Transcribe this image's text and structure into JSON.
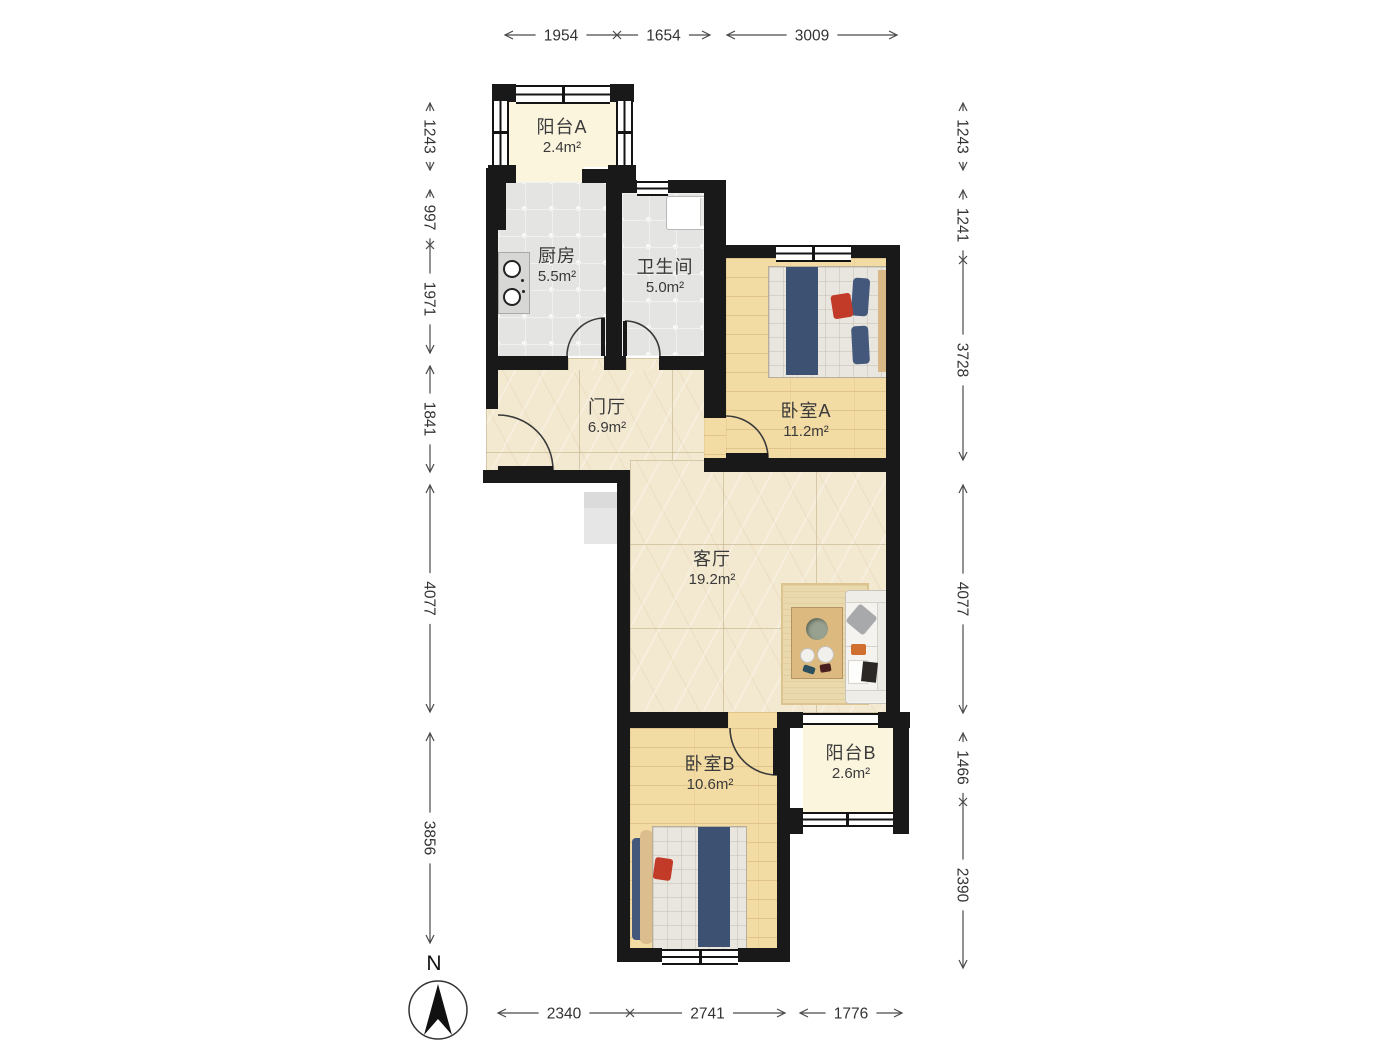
{
  "rooms": {
    "balcony_a": {
      "name": "阳台A",
      "area": "2.4m²"
    },
    "kitchen": {
      "name": "厨房",
      "area": "5.5m²"
    },
    "bathroom": {
      "name": "卫生间",
      "area": "5.0m²"
    },
    "foyer": {
      "name": "门厅",
      "area": "6.9m²"
    },
    "bedroom_a": {
      "name": "卧室A",
      "area": "11.2m²"
    },
    "living_room": {
      "name": "客厅",
      "area": "19.2m²"
    },
    "bedroom_b": {
      "name": "卧室B",
      "area": "10.6m²"
    },
    "balcony_b": {
      "name": "阳台B",
      "area": "2.6m²"
    }
  },
  "compass": {
    "label": "N"
  },
  "dimensions": {
    "top": {
      "y": 35,
      "segments": [
        {
          "value": "1954",
          "from": 505,
          "to": 617,
          "end_marker": "x"
        },
        {
          "value": "1654",
          "from": 617,
          "to": 710,
          "start_marker": "none"
        },
        {
          "value": "3009",
          "from": 727,
          "to": 897
        }
      ]
    },
    "bottom": {
      "y": 1013,
      "segments": [
        {
          "value": "2340",
          "from": 498,
          "to": 630,
          "end_marker": "x"
        },
        {
          "value": "2741",
          "from": 630,
          "to": 785,
          "start_marker": "none"
        },
        {
          "value": "1776",
          "from": 800,
          "to": 902
        }
      ]
    },
    "left": {
      "x": 430,
      "segments": [
        {
          "value": "1243",
          "from": 103,
          "to": 170
        },
        {
          "value": "997",
          "from": 190,
          "to": 245,
          "end_marker": "x"
        },
        {
          "value": "1971",
          "from": 245,
          "to": 353,
          "start_marker": "none"
        },
        {
          "value": "1841",
          "from": 366,
          "to": 472
        },
        {
          "value": "4077",
          "from": 485,
          "to": 712
        },
        {
          "value": "3856",
          "from": 733,
          "to": 943
        }
      ]
    },
    "right": {
      "x": 963,
      "segments": [
        {
          "value": "1243",
          "from": 103,
          "to": 170
        },
        {
          "value": "1241",
          "from": 190,
          "to": 260,
          "end_marker": "x"
        },
        {
          "value": "3728",
          "from": 260,
          "to": 460,
          "start_marker": "none"
        },
        {
          "value": "4077",
          "from": 485,
          "to": 713
        },
        {
          "value": "1466",
          "from": 733,
          "to": 802,
          "end_marker": "x"
        },
        {
          "value": "2390",
          "from": 802,
          "to": 968,
          "start_marker": "none"
        }
      ]
    }
  },
  "colors": {
    "wall": "#191919",
    "balcony_floor": "#FBF5DE",
    "tile_floor": "#E4E4E2",
    "wood_floor": "#F3DBA4",
    "marble_floor": "#F3E8D0",
    "dim_line": "#4a4a4a",
    "dim_text": "#333333",
    "bed_blanket": "#3D5173",
    "accent_pillow": "#C23B28"
  }
}
